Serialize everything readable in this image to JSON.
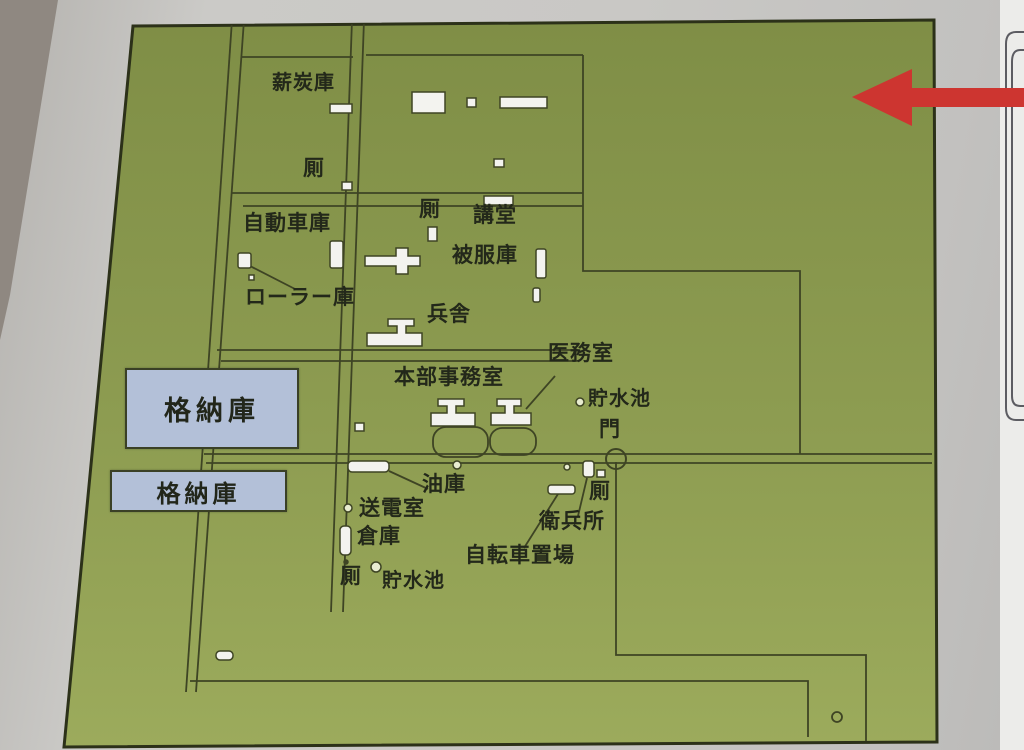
{
  "labels": {
    "fuel_storage": "薪炭庫",
    "toilet_nw": "厠",
    "garage": "自動車庫",
    "toilet_mid": "厠",
    "auditorium": "講堂",
    "clothing_storage": "被服庫",
    "roller_storage": "ローラー庫",
    "barracks": "兵舎",
    "medical_room": "医務室",
    "hq_office": "本部事務室",
    "reservoir_east": "貯水池",
    "gate": "門",
    "hangar_1": "格納庫",
    "hangar_2": "格納庫",
    "oil_storage": "油庫",
    "power_room": "送電室",
    "warehouse": "倉庫",
    "toilet_sw": "厠",
    "reservoir_south": "貯水池",
    "bicycle_parking": "自転車置場",
    "guard_post": "衛兵所",
    "toilet_south": "厠"
  },
  "colors": {
    "board_green": "#8a9950",
    "hangar_blue": "#b3c0d8",
    "arrow_red": "#cd3530",
    "line_dark": "#3e4424"
  }
}
